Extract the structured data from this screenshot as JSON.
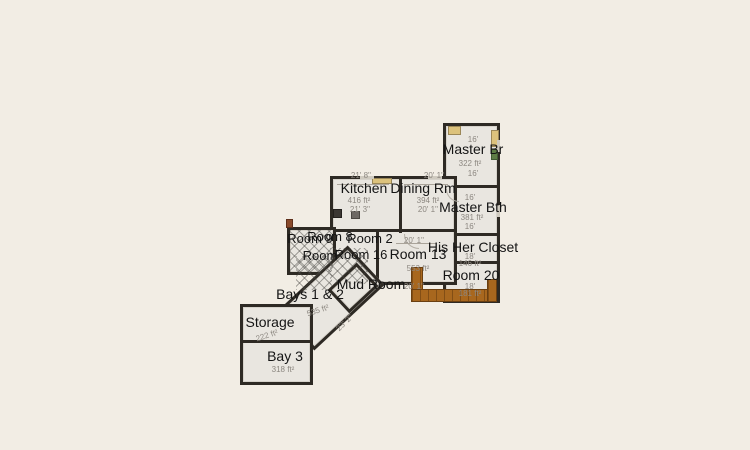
{
  "colors": {
    "background": "#f2ede4",
    "wall": "#2e2a24",
    "room_fill": "#e9e6e0",
    "label_text": "#141414",
    "dimension_text": "#8c8780",
    "wood_deck": "#a8671e",
    "tan_furniture": "#dcc27c",
    "green_plant": "#5e7d46"
  },
  "rooms": {
    "master_br": {
      "name": "Master Br",
      "area": "322 ft²",
      "dim_top": "16'",
      "dim_bottom": "16'"
    },
    "master_bth": {
      "name": "Master Bth",
      "area": "381 ft²",
      "dim_top": "16'",
      "dim_bottom": "16'"
    },
    "kitchen": {
      "name": "Kitchen",
      "area": "416 ft²",
      "dim_top": "21' 8''",
      "dim_bottom": "21' 3''"
    },
    "dining": {
      "name": "Dining Rm",
      "area": "394 ft²",
      "dim_top": "20' 1''",
      "dim_bottom": "20' 1''"
    },
    "room9": {
      "name": "Room 9"
    },
    "room8": {
      "name": "Room 8"
    },
    "room2": {
      "name": "Room 2"
    },
    "room_plain": {
      "name": "Room"
    },
    "room16": {
      "name": "Room 16"
    },
    "room13": {
      "name": "Room 13",
      "area": "553 ft²",
      "dim_top": "20' 1''",
      "dim_bottom": "20' 1''"
    },
    "his_her_closet": {
      "name": "His Her Closet",
      "area": "146 ft²",
      "dim": "18'"
    },
    "room20": {
      "name": "Room 20",
      "area": "181 ft²",
      "dim": "18'"
    },
    "mud_room": {
      "name": "Mud Room"
    },
    "bays_1_2": {
      "name": "Bays 1 & 2",
      "area": "535 ft²",
      "dim": "23' 2''"
    },
    "storage": {
      "name": "Storage",
      "area": "222 ft²"
    },
    "bay3": {
      "name": "Bay 3",
      "area": "318 ft²"
    }
  }
}
